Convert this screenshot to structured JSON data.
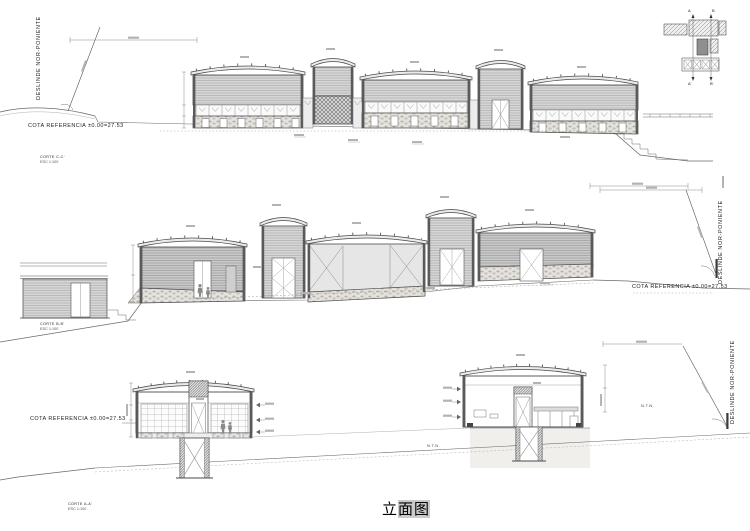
{
  "sheet_title": {
    "part1": "立",
    "part2": "面图"
  },
  "labels": {
    "cota_referencia": "COTA REFERENCIA  ±0.00=27.53",
    "deslinde": "DESLINDE  NOR-PONIENTE",
    "esc": "ESC  1:100"
  },
  "sections": [
    {
      "corte": "CORTE C-C'"
    },
    {
      "corte": "CORTE B-B'"
    },
    {
      "corte": "CORTE A-A'"
    }
  ],
  "annotations": {
    "ntn": "N.T.N."
  },
  "key_plan": {
    "a_top": "A",
    "b_top": "B",
    "a_bottom": "A'",
    "b_bottom": "B'"
  },
  "colors": {
    "paper": "#ffffff",
    "ink": "#4a4a4a",
    "siding": "#d6d6d6",
    "stone": "#e6e3de"
  }
}
